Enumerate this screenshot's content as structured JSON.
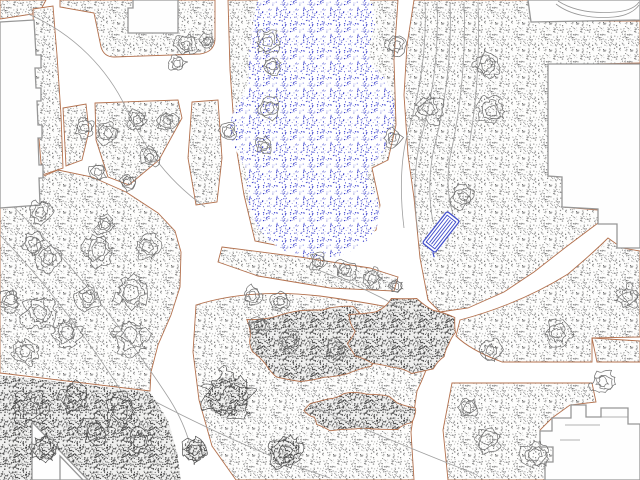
{
  "app": {
    "name": "site-plan-canvas",
    "description": "Landscape architecture site plan: pond with blue stipple, stippled planting beds outlined in sienna, scribbled trees, white walkways, building footprints and a selected blue bench symbol"
  },
  "canvas": {
    "width": 640,
    "height": 480
  },
  "colors": {
    "background": "#ffffff",
    "paper": "#fdfdfc",
    "bed_outline": "#b3714e",
    "building_outline": "#979797",
    "building_fill": "#fefefe",
    "stipple_dot": "#8e8e8e",
    "stipple_dark_dot": "#4e4e4e",
    "dark_bg": "#efefee",
    "water_dot": "#3c43cf",
    "water_dot_light": "#8b90e4",
    "water_dot_deep": "#1d24b8",
    "tree_stroke": "#6e6e6e",
    "tree_dark_stroke": "#4f4f4f",
    "contour": "#9f9f9f",
    "bench": "#4350cc"
  },
  "map": {
    "beds": [
      {
        "id": "corner-nw",
        "d": "M0,0 L46,0 L39,13 L0,19 Z"
      },
      {
        "id": "band-left",
        "d": "M33,9 L53,6 L57,55 L61,115 L63,168 L42,175 L37,115 L34,55 Z"
      },
      {
        "id": "plaza-north",
        "d": "M60,0 L215,0 L215,40 Q214,52 200,54 L114,57 Q104,57 101,47 L94,13 L60,7 Z"
      },
      {
        "id": "pond-bed",
        "d": "M228,0 L398,0 L394,60 L396,125 L388,160 L372,168 L380,205 L376,230 L340,252 L295,249 L255,241 L244,195 L235,140 L230,70 Z"
      },
      {
        "id": "tree-row",
        "d": "M222,247 L300,257 L370,268 L398,277 L394,291 L330,288 L258,276 L218,262 Z"
      },
      {
        "id": "east-lawn",
        "d": "M414,0 L528,0 L531,21 L640,21 L640,63 L548,65 L548,176 L562,177 L562,207 L598,210 L598,223 L566,247 L534,272 L504,292 L468,308 L440,312 L428,300 L420,258 L414,198 L408,155 L404,95 L407,45 Z"
      },
      {
        "id": "junction-east",
        "d": "M460,320 Q520,304 568,274 Q594,252 608,238 L622,248 L640,251 L640,337 L592,338 L592,362 L502,362 Q470,350 456,336 Z"
      },
      {
        "id": "southeast-lawn",
        "d": "M452,383 L592,383 L596,402 L570,405 L552,418 L540,430 L540,447 L553,447 L553,462 L545,462 L545,480 L448,480 L443,430 Z"
      },
      {
        "id": "west-lawn",
        "d": "M39,178 L58,170 L92,177 L126,192 L158,213 L175,231 L181,252 L180,287 L171,315 L158,345 L151,372 L150,391 L0,373 L0,208 L38,205 Z"
      },
      {
        "id": "bed-a",
        "d": "M63,108 L86,104 L89,131 L82,160 L66,166 Z"
      },
      {
        "id": "bed-b",
        "d": "M95,103 L178,100 L182,118 L159,160 L129,185 L108,177 L96,140 Z"
      },
      {
        "id": "bed-c",
        "d": "M192,102 L218,100 L222,158 L217,202 L196,205 L188,158 Z"
      },
      {
        "id": "south-central",
        "d": "M196,305 Q250,288 320,296 Q392,306 428,316 L438,332 Q431,362 417,391 L411,432 L414,480 L236,480 L212,446 L199,400 L193,352 Z"
      },
      {
        "id": "se-strip",
        "d": "M592,338 L640,341 L640,362 L597,362 Z"
      }
    ],
    "dense_areas": [
      {
        "id": "dense-sw",
        "d": "M0,375 L150,392 L168,420 L177,452 L181,480 L0,480 Z"
      }
    ],
    "shrubs": [
      {
        "cx": 312,
        "cy": 344,
        "rx": 68,
        "ry": 40,
        "seed": 11
      },
      {
        "cx": 402,
        "cy": 338,
        "rx": 58,
        "ry": 36,
        "seed": 23
      },
      {
        "cx": 360,
        "cy": 413,
        "rx": 56,
        "ry": 19,
        "seed": 37
      }
    ],
    "buildings": [
      {
        "id": "building-west",
        "d": "M0,22 L34,20 L36,55 L41,55 L41,68 L35,68 L36,88 L41,88 L41,101 L37,101 L38,125 L42,125 L42,138 L38,138 L39,165 L43,165 L43,178 L39,178 L40,205 L0,208 Z"
      },
      {
        "id": "building-north",
        "d": "M133,0 L178,0 L178,33 L128,33 L128,8 L133,8 Z"
      },
      {
        "id": "building-northeast",
        "d": "M528,0 L640,0 L640,20 L531,22 Z"
      },
      {
        "id": "building-east",
        "d": "M548,64 L640,64 L640,248 L617,248 L617,224 L598,224 L598,209 L562,207 L562,177 L548,176 Z"
      },
      {
        "id": "building-southeast",
        "d": "M545,480 L545,462 L553,462 L553,447 L540,447 L540,431 L552,431 L552,418 L571,418 L571,405 L586,405 L586,417 L601,417 L601,408 L628,408 L628,424 L640,424 L640,480 Z"
      },
      {
        "id": "building-southwest-a",
        "d": "M32,422 L88,480 L32,480 Z"
      },
      {
        "id": "building-southwest-b",
        "d": "M60,456 L83,480 L60,480 Z"
      }
    ],
    "building_details": [
      "M556,4 C570,15 592,19 614,17 C626,16 635,11 639,5",
      "M558,1 C572,10 592,14 616,12 C628,11 636,7 639,2",
      "M565,425 L600,425",
      "M600,417 L628,417",
      "M560,440 L580,440"
    ],
    "pond": {
      "d": "M258,0 L370,0 C376,10 377,24 372,36 C366,50 368,60 378,70 C390,82 396,100 394,120 C392,140 384,152 376,160 C368,168 366,176 371,186 C378,198 382,208 379,220 C375,236 362,248 344,254 C324,261 300,259 283,250 C266,241 254,226 250,208 C246,192 249,178 243,164 C237,150 229,143 230,126 C231,110 241,102 246,88 C251,74 247,62 250,46 C252,32 254,12 258,0 Z"
    },
    "contours": [
      "M28,14 C75,34 108,70 126,108 C140,138 160,175 205,207",
      "M2,196 C55,245 115,315 170,400 C180,416 186,430 190,445",
      "M0,235 C45,282 100,352 150,438",
      "M425,2 C427,48 420,92 408,132 C400,160 400,196 404,228",
      "M437,2 C439,50 433,96 421,138 C414,164 413,198 418,232",
      "M450,2 C452,52 446,100 435,144 C429,168 428,196 433,222",
      "M464,2 C466,54 461,104 452,148 C446,172 447,196 453,214",
      "M478,2 C480,56 476,108 468,152",
      "M152,400 C210,430 270,458 330,478",
      "M310,405 C360,428 420,452 475,474",
      "M318,270 C350,282 380,296 408,312"
    ],
    "trees": [
      [
        186,
        45,
        11
      ],
      [
        177,
        63,
        9
      ],
      [
        207,
        41,
        8
      ],
      [
        268,
        42,
        12
      ],
      [
        272,
        66,
        10
      ],
      [
        270,
        108,
        11
      ],
      [
        264,
        146,
        9
      ],
      [
        228,
        132,
        9
      ],
      [
        397,
        45,
        10
      ],
      [
        393,
        138,
        9
      ],
      [
        429,
        108,
        14
      ],
      [
        487,
        65,
        13
      ],
      [
        491,
        111,
        14
      ],
      [
        463,
        196,
        12
      ],
      [
        318,
        262,
        9
      ],
      [
        345,
        270,
        10
      ],
      [
        372,
        278,
        10
      ],
      [
        396,
        286,
        8
      ],
      [
        252,
        296,
        10
      ],
      [
        280,
        302,
        9
      ],
      [
        85,
        128,
        10
      ],
      [
        108,
        133,
        11
      ],
      [
        137,
        120,
        11
      ],
      [
        167,
        121,
        10
      ],
      [
        150,
        157,
        10
      ],
      [
        98,
        172,
        9
      ],
      [
        128,
        182,
        9
      ],
      [
        40,
        212,
        12
      ],
      [
        33,
        243,
        11
      ],
      [
        48,
        258,
        13
      ],
      [
        98,
        250,
        16
      ],
      [
        148,
        247,
        12
      ],
      [
        131,
        293,
        17
      ],
      [
        40,
        313,
        17
      ],
      [
        67,
        333,
        15
      ],
      [
        130,
        336,
        18
      ],
      [
        10,
        300,
        12
      ],
      [
        105,
        225,
        10
      ],
      [
        88,
        298,
        12
      ],
      [
        25,
        352,
        13
      ],
      [
        290,
        342,
        11
      ],
      [
        335,
        350,
        11
      ],
      [
        258,
        325,
        10
      ],
      [
        228,
        397,
        24,
        1
      ],
      [
        285,
        452,
        17,
        1
      ],
      [
        195,
        450,
        13,
        1
      ],
      [
        30,
        408,
        17,
        1
      ],
      [
        75,
        398,
        15,
        1
      ],
      [
        120,
        412,
        17,
        1
      ],
      [
        45,
        448,
        14,
        1
      ],
      [
        140,
        442,
        14,
        1
      ],
      [
        95,
        430,
        15,
        1
      ],
      [
        490,
        351,
        11
      ],
      [
        558,
        333,
        13
      ],
      [
        628,
        296,
        12
      ],
      [
        603,
        382,
        12
      ],
      [
        487,
        440,
        13
      ],
      [
        535,
        455,
        14
      ],
      [
        468,
        408,
        10
      ]
    ],
    "bench": {
      "x": 441,
      "y": 232,
      "angle": -52,
      "length": 40,
      "width": 16
    }
  }
}
